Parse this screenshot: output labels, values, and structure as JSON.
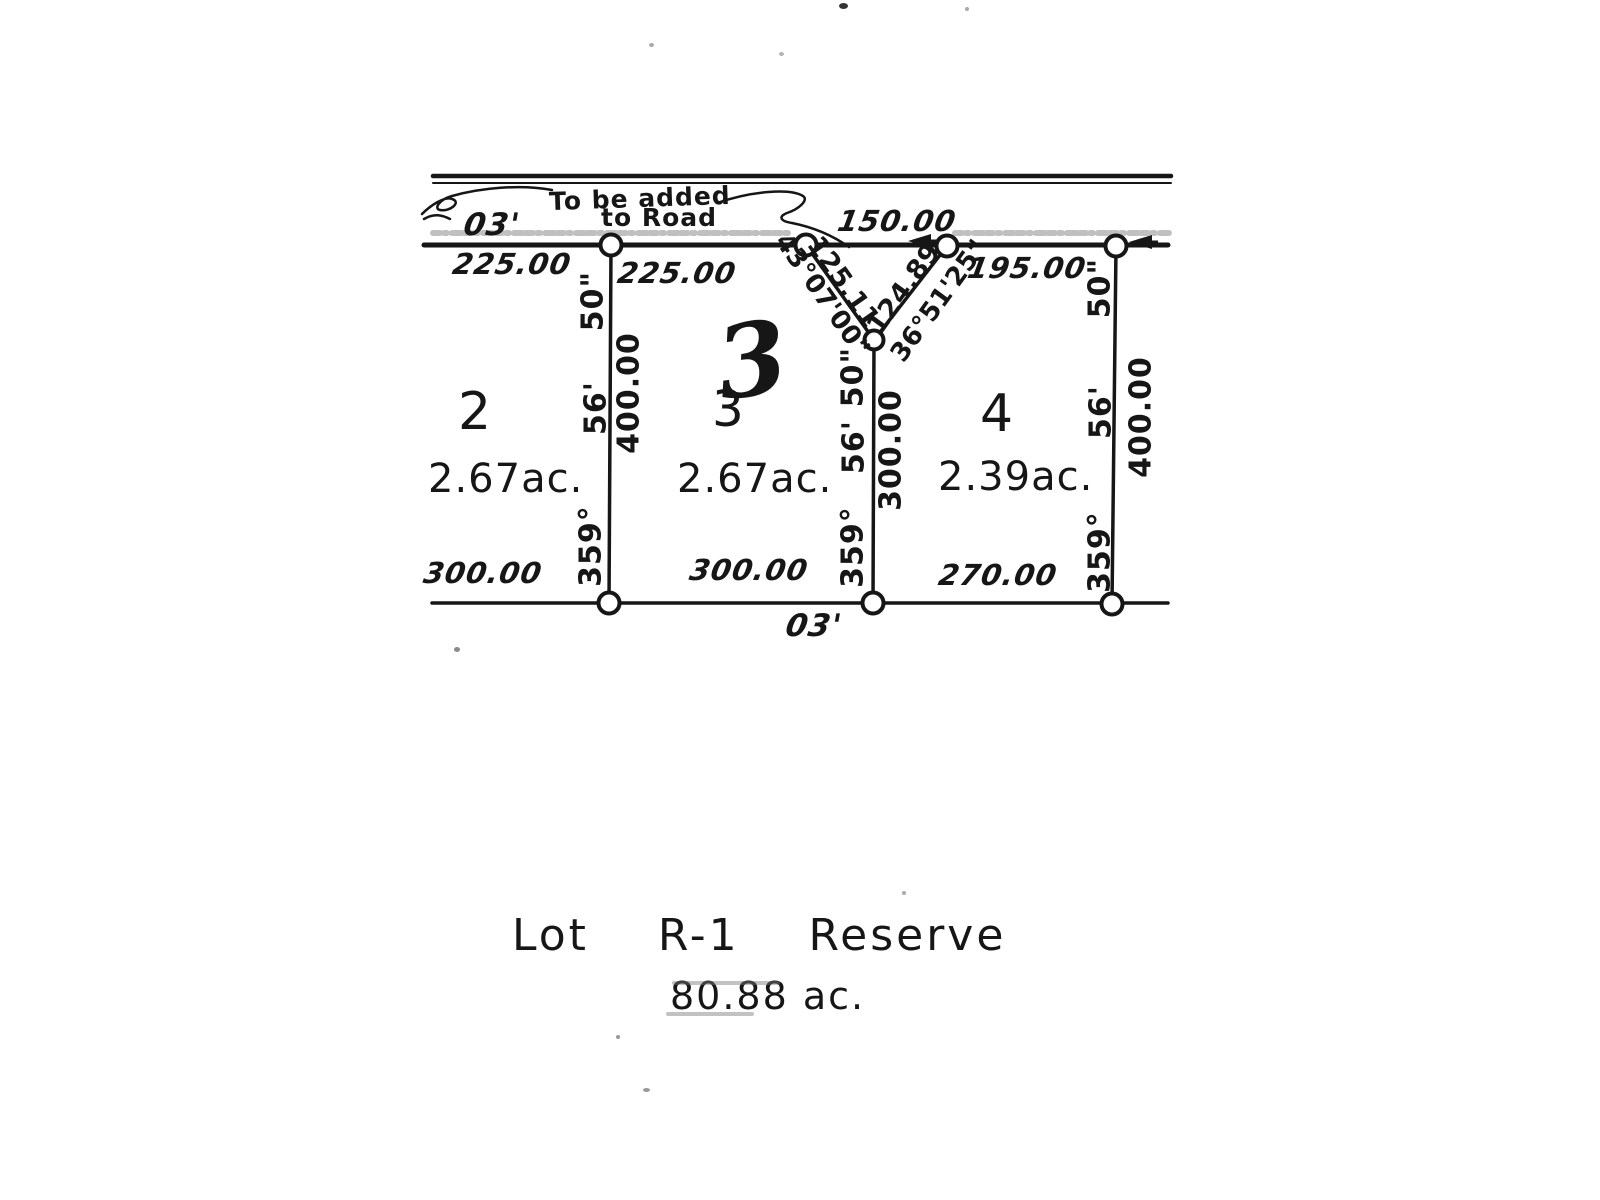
{
  "plat": {
    "note": {
      "line1": "To be added",
      "line2": "to Road"
    },
    "road": {
      "bearing_min_left": "03'",
      "gap_dist": "150.00"
    },
    "frontages": {
      "lot2": "225.00",
      "lot3": "225.00",
      "lot4": "195.00"
    },
    "rears": {
      "lot2": "300.00",
      "lot3": "300.00",
      "lot4": "270.00",
      "bearing_min": "03'"
    },
    "bearing": {
      "deg": "359°",
      "min": "56'",
      "sec": "50\""
    },
    "depths": {
      "left": "400.00",
      "middle": "300.00",
      "right": "400.00"
    },
    "v_boundary": {
      "left": {
        "dist": "125.11",
        "bearing": "43°07'00\""
      },
      "right": {
        "dist": "124.89",
        "bearing": "36°51'25\""
      }
    },
    "lots": {
      "lot2": {
        "number": "2",
        "area": "2.67ac."
      },
      "lot3": {
        "number_script": "3",
        "number": "3",
        "area": "2.67ac."
      },
      "lot4": {
        "number": "4",
        "area": "2.39ac."
      }
    },
    "reserve": {
      "title": "Lot R-1 Reserve",
      "area": "80.88 ac."
    }
  }
}
